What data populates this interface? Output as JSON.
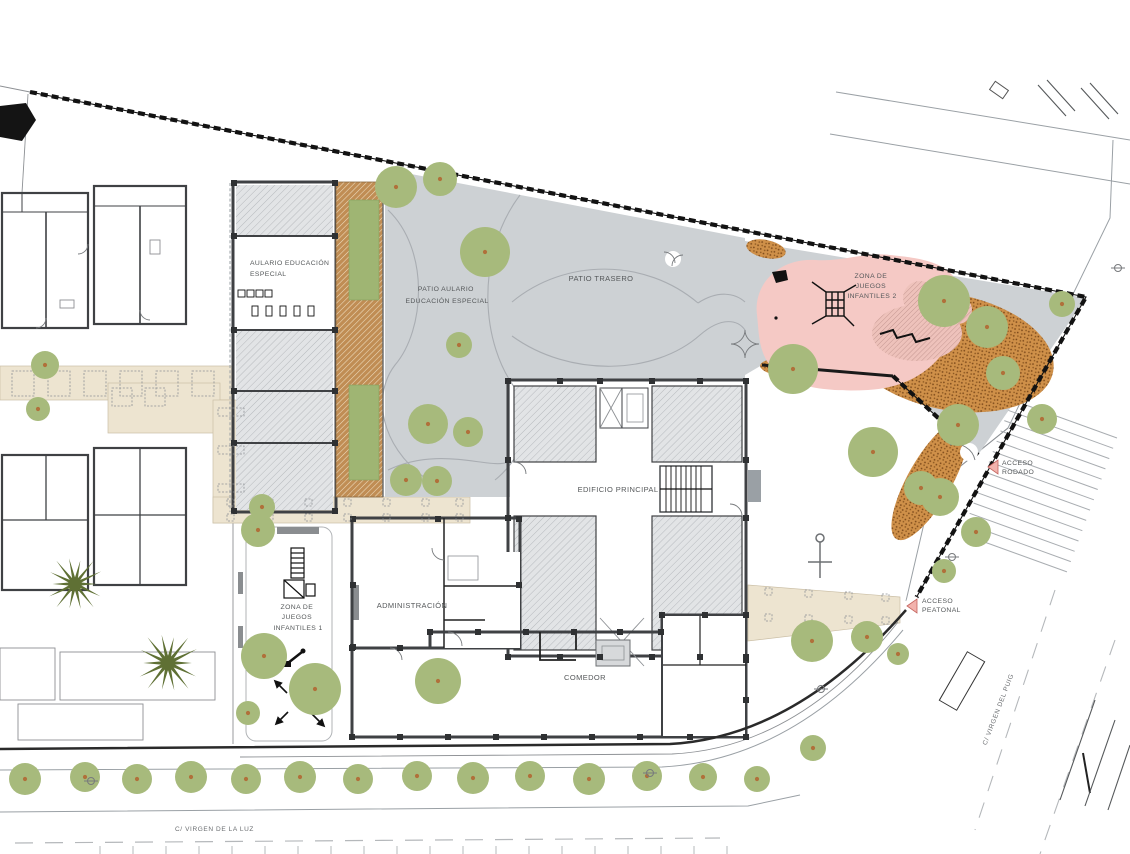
{
  "labels": {
    "aulario_1": "AULARIO EDUCACIÓN",
    "aulario_2": "ESPECIAL",
    "patio_aulario_1": "PATIO AULARIO",
    "patio_aulario_2": "EDUCACIÓN ESPECIAL",
    "patio_trasero": "PATIO TRASERO",
    "zona2_1": "ZONA DE",
    "zona2_2": "JUEGOS",
    "zona2_3": "INFANTILES 2",
    "edificio_principal": "EDIFICIO PRINCIPAL",
    "administracion": "ADMINISTRACIÓN",
    "comedor": "COMEDOR",
    "zona1_1": "ZONA DE",
    "zona1_2": "JUEGOS",
    "zona1_3": "INFANTILES 1",
    "acceso_rodado_1": "ACCESO",
    "acceso_rodado_2": "RODADO",
    "acceso_peatonal_1": "ACCESO",
    "acceso_peatonal_2": "PEATONAL",
    "calle_luz": "C/ VIRGEN DE LA LUZ",
    "calle_puig": "C/ VIRGEN DEL PUIG"
  },
  "palette": {
    "patio_gray": "#cdd1d4",
    "room_gray_bg": "#e2e4e6",
    "room_hatch_line": "#b6b9bd",
    "comedor_bg": "#edeeef",
    "comedor_hatch_line": "#ccd0d3",
    "pink": "#f5c9c5",
    "pink_hatch_bg": "#eec2bb",
    "pink_hatch_line": "#bb8d87",
    "beige": "#ede4d0",
    "brown_bg": "#c08d54",
    "brown_hatch_line": "#efdfc2",
    "dirt_bg": "#cf9049",
    "dirt_dot": "#7d4a1b",
    "tree": "#a7ba7c",
    "tree_trunk": "#b0703a",
    "palm": "#5f7034",
    "wall": "#3f4144",
    "fence": "#121212",
    "access_fill": "#f2b3ad",
    "access_stroke": "#c4635e",
    "label": "#55585a"
  },
  "plan": {
    "trees": [
      [
        396,
        187,
        21
      ],
      [
        440,
        179,
        17
      ],
      [
        485,
        252,
        25
      ],
      [
        459,
        345,
        13
      ],
      [
        428,
        424,
        20
      ],
      [
        468,
        432,
        15
      ],
      [
        406,
        480,
        16
      ],
      [
        437,
        481,
        15
      ],
      [
        793,
        369,
        25
      ],
      [
        944,
        301,
        26
      ],
      [
        987,
        327,
        21
      ],
      [
        1003,
        373,
        17
      ],
      [
        958,
        425,
        21
      ],
      [
        1042,
        419,
        15
      ],
      [
        873,
        452,
        25
      ],
      [
        921,
        488,
        17
      ],
      [
        1062,
        304,
        13
      ],
      [
        940,
        497,
        19
      ],
      [
        976,
        532,
        15
      ],
      [
        944,
        571,
        12
      ],
      [
        812,
        641,
        21
      ],
      [
        867,
        637,
        16
      ],
      [
        898,
        654,
        11
      ],
      [
        813,
        748,
        13
      ],
      [
        315,
        689,
        26
      ],
      [
        438,
        681,
        23
      ],
      [
        258,
        530,
        17
      ],
      [
        264,
        656,
        23
      ],
      [
        248,
        713,
        12
      ],
      [
        262,
        507,
        13
      ],
      [
        45,
        365,
        14
      ],
      [
        38,
        409,
        12
      ],
      [
        25,
        779,
        16
      ],
      [
        85,
        777,
        15
      ],
      [
        137,
        779,
        15
      ],
      [
        191,
        777,
        16
      ],
      [
        246,
        779,
        15
      ],
      [
        300,
        777,
        16
      ],
      [
        358,
        779,
        15
      ],
      [
        417,
        776,
        15
      ],
      [
        473,
        778,
        16
      ],
      [
        530,
        776,
        15
      ],
      [
        589,
        779,
        16
      ],
      [
        647,
        776,
        15
      ],
      [
        703,
        777,
        14
      ],
      [
        757,
        779,
        13
      ]
    ],
    "palms": [
      [
        75,
        584,
        30
      ],
      [
        168,
        663,
        33
      ]
    ],
    "lamps": [
      [
        650,
        773
      ],
      [
        91,
        781
      ],
      [
        1118,
        268
      ],
      [
        952,
        557
      ],
      [
        821,
        689
      ]
    ],
    "columns": [
      [
        508,
        381
      ],
      [
        560,
        381
      ],
      [
        600,
        381
      ],
      [
        652,
        381
      ],
      [
        700,
        381
      ],
      [
        746,
        381
      ],
      [
        508,
        657
      ],
      [
        560,
        657
      ],
      [
        600,
        657
      ],
      [
        652,
        657
      ],
      [
        700,
        657
      ],
      [
        746,
        657
      ],
      [
        508,
        460
      ],
      [
        508,
        518
      ],
      [
        746,
        460
      ],
      [
        746,
        518
      ],
      [
        234,
        183
      ],
      [
        335,
        183
      ],
      [
        234,
        236
      ],
      [
        335,
        236
      ],
      [
        234,
        330
      ],
      [
        335,
        330
      ],
      [
        234,
        391
      ],
      [
        335,
        391
      ],
      [
        234,
        443
      ],
      [
        335,
        443
      ],
      [
        234,
        511
      ],
      [
        335,
        511
      ],
      [
        353,
        519
      ],
      [
        438,
        519
      ],
      [
        519,
        519
      ],
      [
        353,
        585
      ],
      [
        353,
        647
      ],
      [
        519,
        585
      ],
      [
        430,
        632
      ],
      [
        478,
        632
      ],
      [
        526,
        632
      ],
      [
        574,
        632
      ],
      [
        620,
        632
      ],
      [
        661,
        632
      ],
      [
        352,
        648
      ],
      [
        400,
        648
      ],
      [
        352,
        737
      ],
      [
        400,
        737
      ],
      [
        448,
        737
      ],
      [
        496,
        737
      ],
      [
        544,
        737
      ],
      [
        592,
        737
      ],
      [
        640,
        737
      ],
      [
        690,
        737
      ],
      [
        746,
        737
      ],
      [
        746,
        660
      ],
      [
        746,
        700
      ],
      [
        662,
        615
      ],
      [
        705,
        615
      ],
      [
        746,
        615
      ]
    ],
    "walk_ticks": [
      [
        12,
        371,
        22,
        25
      ],
      [
        48,
        371,
        22,
        25
      ],
      [
        84,
        371,
        22,
        25
      ],
      [
        120,
        371,
        22,
        25
      ],
      [
        156,
        371,
        22,
        25
      ],
      [
        192,
        371,
        22,
        25
      ],
      [
        112,
        388,
        20,
        18
      ],
      [
        145,
        388,
        20,
        18
      ],
      [
        218,
        408,
        26,
        8
      ],
      [
        218,
        446,
        26,
        8
      ],
      [
        218,
        484,
        26,
        8
      ],
      [
        227,
        499,
        7,
        7
      ],
      [
        266,
        499,
        7,
        7
      ],
      [
        305,
        499,
        7,
        7
      ],
      [
        344,
        499,
        7,
        7
      ],
      [
        383,
        499,
        7,
        7
      ],
      [
        422,
        499,
        7,
        7
      ],
      [
        456,
        499,
        7,
        7
      ],
      [
        227,
        514,
        7,
        7
      ],
      [
        266,
        514,
        7,
        7
      ],
      [
        305,
        514,
        7,
        7
      ],
      [
        344,
        514,
        7,
        7
      ],
      [
        383,
        514,
        7,
        7
      ],
      [
        422,
        514,
        7,
        7
      ],
      [
        456,
        514,
        7,
        7
      ],
      [
        765,
        588,
        7,
        7
      ],
      [
        805,
        590,
        7,
        7
      ],
      [
        845,
        592,
        7,
        7
      ],
      [
        882,
        594,
        7,
        7
      ],
      [
        765,
        614,
        7,
        7
      ],
      [
        805,
        615,
        7,
        7
      ],
      [
        845,
        616,
        7,
        7
      ],
      [
        882,
        617,
        7,
        7
      ]
    ],
    "parking_stripes": {
      "start": [
        1012,
        400
      ],
      "step": [
        -3.85,
        10.3
      ],
      "offset": [
        105,
        38
      ],
      "count": 14
    },
    "curb_ticks": {
      "start": [
        100,
        846
      ],
      "step": [
        33,
        0
      ],
      "offset": [
        0,
        8
      ],
      "count": 20
    },
    "parking_marks": [
      [
        1038,
        85,
        1066,
        116
      ],
      [
        1047,
        80,
        1075,
        111
      ],
      [
        1081,
        88,
        1109,
        119
      ],
      [
        1090,
        83,
        1118,
        114
      ],
      [
        1095,
        700,
        1060,
        800
      ],
      [
        1115,
        720,
        1085,
        806
      ],
      [
        1130,
        745,
        1108,
        810
      ]
    ]
  }
}
